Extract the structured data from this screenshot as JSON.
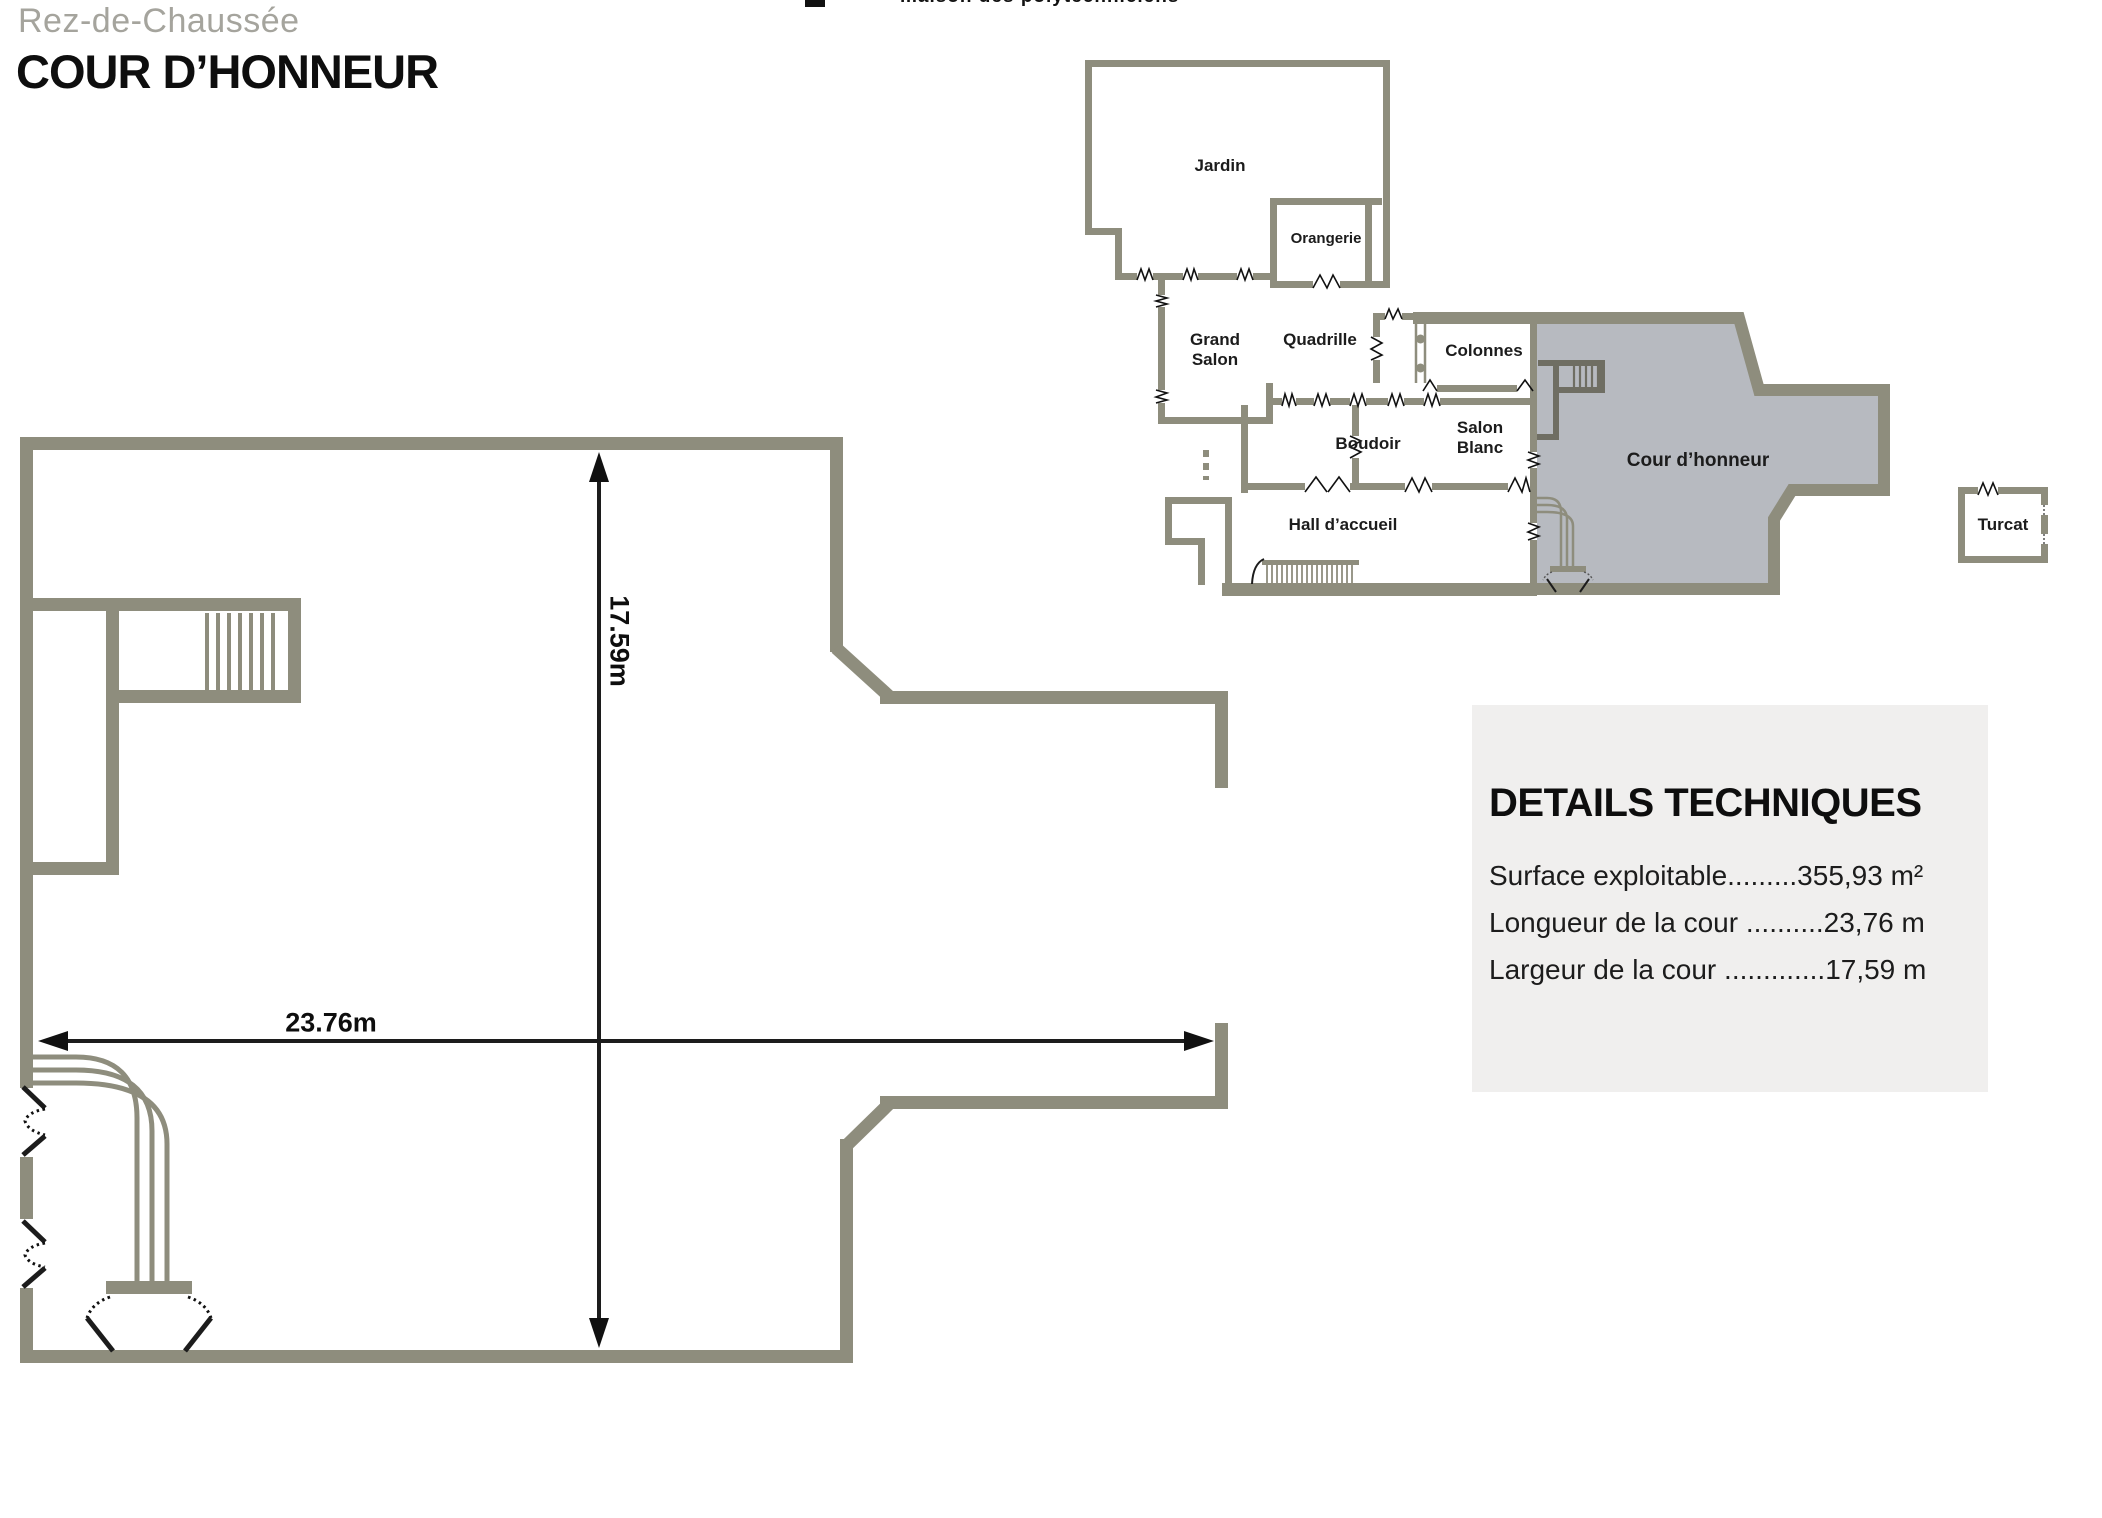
{
  "header": {
    "site_name_clipped": "maison des polytechniciens",
    "floor_label": "Rez-de-Chaussée",
    "page_title": "COUR D’HONNEUR"
  },
  "main_plan": {
    "width_dimension": "23.76m",
    "height_dimension": "17.59m"
  },
  "minimap": {
    "rooms": [
      {
        "label": "Jardin"
      },
      {
        "label": "Orangerie"
      },
      {
        "label": "Grand\nSalon"
      },
      {
        "label": "Quadrille"
      },
      {
        "label": "Colonnes"
      },
      {
        "label": "Boudoir"
      },
      {
        "label": "Salon\nBlanc"
      },
      {
        "label": "Hall d’accueil"
      },
      {
        "label": "Cour d’honneur"
      },
      {
        "label": "Turcat"
      }
    ]
  },
  "details_panel": {
    "title": "DETAILS TECHNIQUES",
    "specs": [
      {
        "label": "Surface exploitable",
        "dots": ".........",
        "value": "355,93 m²"
      },
      {
        "label": "Longueur de la cour ",
        "dots": "..........",
        "value": "23,76 m"
      },
      {
        "label": "Largeur de la cour ",
        "dots": ".............",
        "value": "17,59 m"
      }
    ]
  },
  "colors": {
    "wall": "#8e8d7d",
    "wall_dark": "#6f6e63",
    "courtyard_highlight": "#b7bac0",
    "panel_background": "#f0efee",
    "muted_heading": "#a5a49d",
    "ink": "#1c1c1c"
  }
}
